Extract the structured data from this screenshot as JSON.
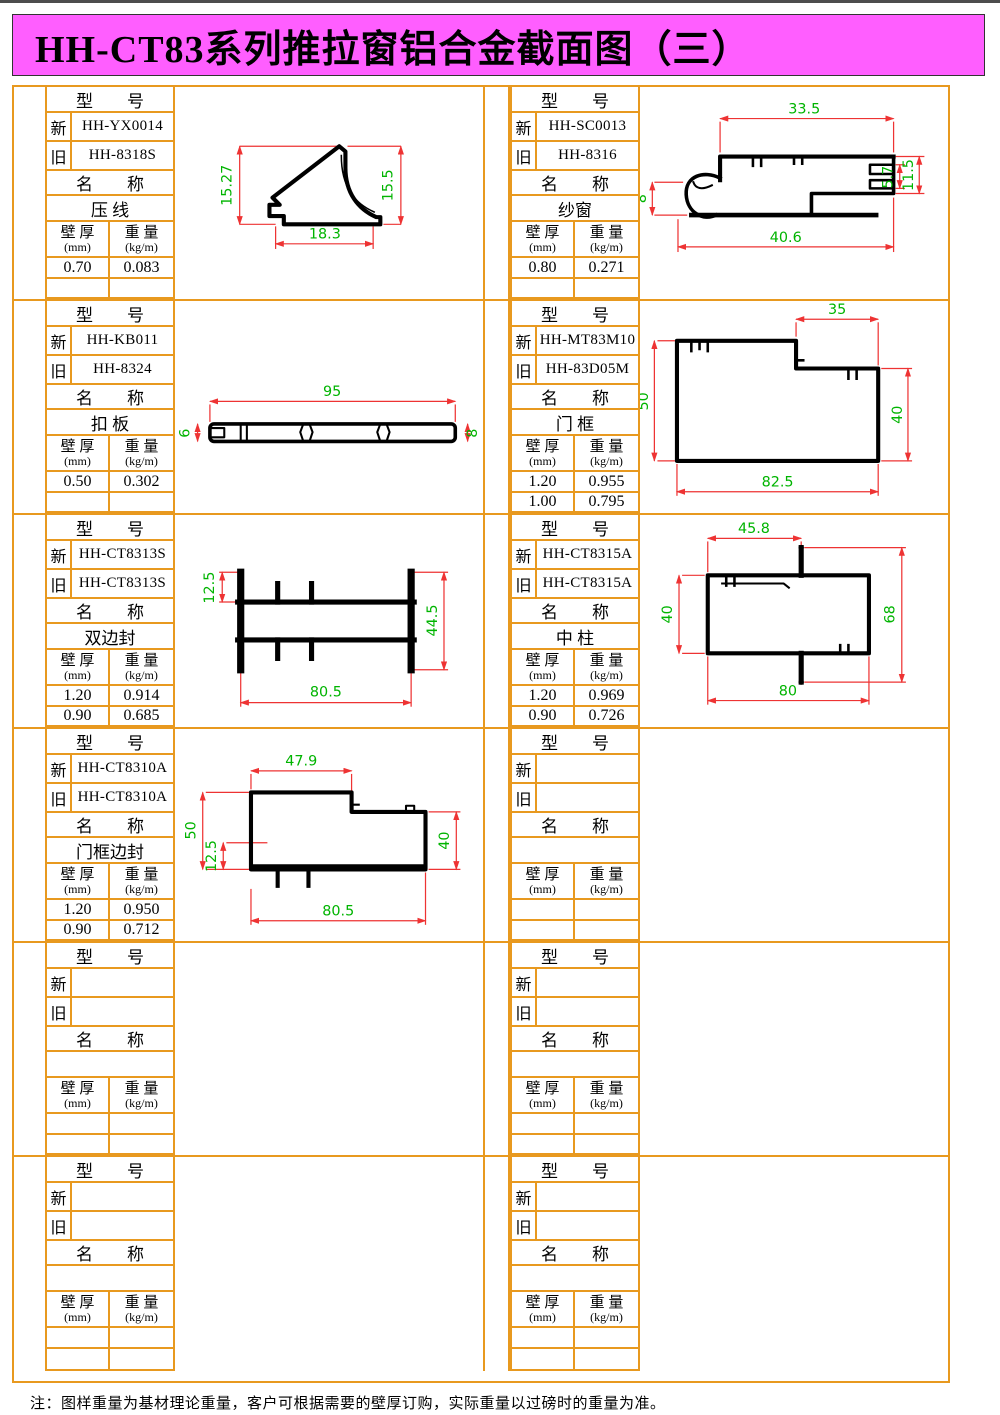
{
  "page": {
    "title": "HH-CT83系列推拉窗铝合金截面图（三）",
    "footer_note": "注：图样重量为基材理论重量，客户可根据需要的壁厚订购，实际重量以过磅时的重量为准。"
  },
  "labels": {
    "model_header": "型　　号",
    "new": "新",
    "old": "旧",
    "name_header": "名　　称",
    "wall_line1": "壁 厚",
    "wall_unit": "(mm)",
    "weight_line1": "重 量",
    "weight_unit": "(kg/m)"
  },
  "colors": {
    "banner_magenta": "#ff5eff",
    "table_orange": "#e8991f",
    "dimension_red": "#ee3333",
    "dimension_green": "#00b400",
    "profile_black": "#000000"
  },
  "panels": [
    {
      "new_model": "HH-YX0014",
      "old_model": "HH-8318S",
      "name": "压 线",
      "data_rows": [
        {
          "wall": "0.70",
          "weight": "0.083"
        },
        {
          "wall": "",
          "weight": ""
        }
      ],
      "dims": {
        "left": "15.27",
        "right": "15.5",
        "bottom": "18.3"
      }
    },
    {
      "new_model": "HH-SC0013",
      "old_model": "HH-8316",
      "name": "纱窗",
      "data_rows": [
        {
          "wall": "0.80",
          "weight": "0.271"
        },
        {
          "wall": "",
          "weight": ""
        }
      ],
      "dims": {
        "top": "33.5",
        "left": "8",
        "right_inner": "5.7",
        "right": "11.5",
        "bottom": "40.6"
      }
    },
    {
      "new_model": "HH-KB011",
      "old_model": "HH-8324",
      "name": "扣 板",
      "data_rows": [
        {
          "wall": "0.50",
          "weight": "0.302"
        },
        {
          "wall": "",
          "weight": ""
        }
      ],
      "dims": {
        "top": "95",
        "left": "6",
        "right": "8"
      }
    },
    {
      "new_model": "HH-MT83M10",
      "old_model": "HH-83D05M",
      "name": "门 框",
      "data_rows": [
        {
          "wall": "1.20",
          "weight": "0.955"
        },
        {
          "wall": "1.00",
          "weight": "0.795"
        }
      ],
      "dims": {
        "top": "35",
        "left": "50",
        "right": "40",
        "bottom": "82.5"
      }
    },
    {
      "new_model": "HH-CT8313S",
      "old_model": "HH-CT8313S",
      "name": "双边封",
      "data_rows": [
        {
          "wall": "1.20",
          "weight": "0.914"
        },
        {
          "wall": "0.90",
          "weight": "0.685"
        }
      ],
      "dims": {
        "top_left": "12.5",
        "right": "44.5",
        "bottom": "80.5"
      }
    },
    {
      "new_model": "HH-CT8315A",
      "old_model": "HH-CT8315A",
      "name": "中 柱",
      "data_rows": [
        {
          "wall": "1.20",
          "weight": "0.969"
        },
        {
          "wall": "0.90",
          "weight": "0.726"
        }
      ],
      "dims": {
        "top": "45.8",
        "left": "40",
        "right": "68",
        "bottom": "80"
      }
    },
    {
      "new_model": "HH-CT8310A",
      "old_model": "HH-CT8310A",
      "name": "门框边封",
      "data_rows": [
        {
          "wall": "1.20",
          "weight": "0.950"
        },
        {
          "wall": "0.90",
          "weight": "0.712"
        }
      ],
      "dims": {
        "top": "47.9",
        "left": "50",
        "left_inner": "12.5",
        "right": "40",
        "bottom": "80.5"
      }
    },
    {
      "new_model": "",
      "old_model": "",
      "name": "",
      "data_rows": [
        {
          "wall": "",
          "weight": ""
        },
        {
          "wall": "",
          "weight": ""
        }
      ]
    },
    {
      "new_model": "",
      "old_model": "",
      "name": "",
      "data_rows": [
        {
          "wall": "",
          "weight": ""
        },
        {
          "wall": "",
          "weight": ""
        }
      ]
    },
    {
      "new_model": "",
      "old_model": "",
      "name": "",
      "data_rows": [
        {
          "wall": "",
          "weight": ""
        },
        {
          "wall": "",
          "weight": ""
        }
      ]
    },
    {
      "new_model": "",
      "old_model": "",
      "name": "",
      "data_rows": [
        {
          "wall": "",
          "weight": ""
        },
        {
          "wall": "",
          "weight": ""
        }
      ]
    },
    {
      "new_model": "",
      "old_model": "",
      "name": "",
      "data_rows": [
        {
          "wall": "",
          "weight": ""
        },
        {
          "wall": "",
          "weight": ""
        }
      ]
    }
  ]
}
